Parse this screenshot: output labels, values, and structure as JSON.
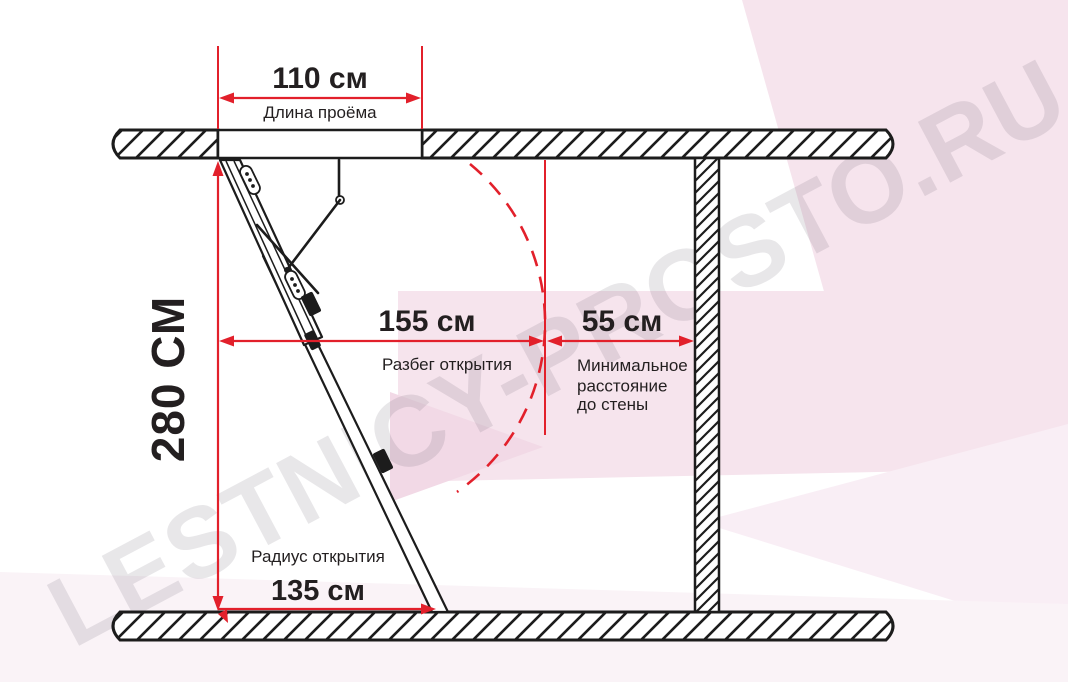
{
  "diagram_title": "Attic folding ladder installation clearances",
  "colors": {
    "accent_red": "#e2202b",
    "line_black": "#1c1c1c",
    "text_dark": "#231f20",
    "bg_pink": "#f6e4ed",
    "bg_pink_soft": "#f9eef5",
    "bg_pink_strong": "#f2d9e6",
    "bg_pink_faint": "#faf3f7",
    "watermark": "#5d5360"
  },
  "watermark": {
    "text": "LESTNICY-PROSTO.RU"
  },
  "dimensions": {
    "opening": {
      "value": "110 см",
      "label": "Длина проёма"
    },
    "height": {
      "value": "280 СМ"
    },
    "run": {
      "value": "155 см",
      "label": "Разбег открытия"
    },
    "wall_clearance": {
      "value": "55 см",
      "label_lines": [
        "Минимальное",
        "расстояние",
        "до стены"
      ]
    },
    "radius": {
      "value": "135 см",
      "label": "Радиус открытия"
    }
  }
}
